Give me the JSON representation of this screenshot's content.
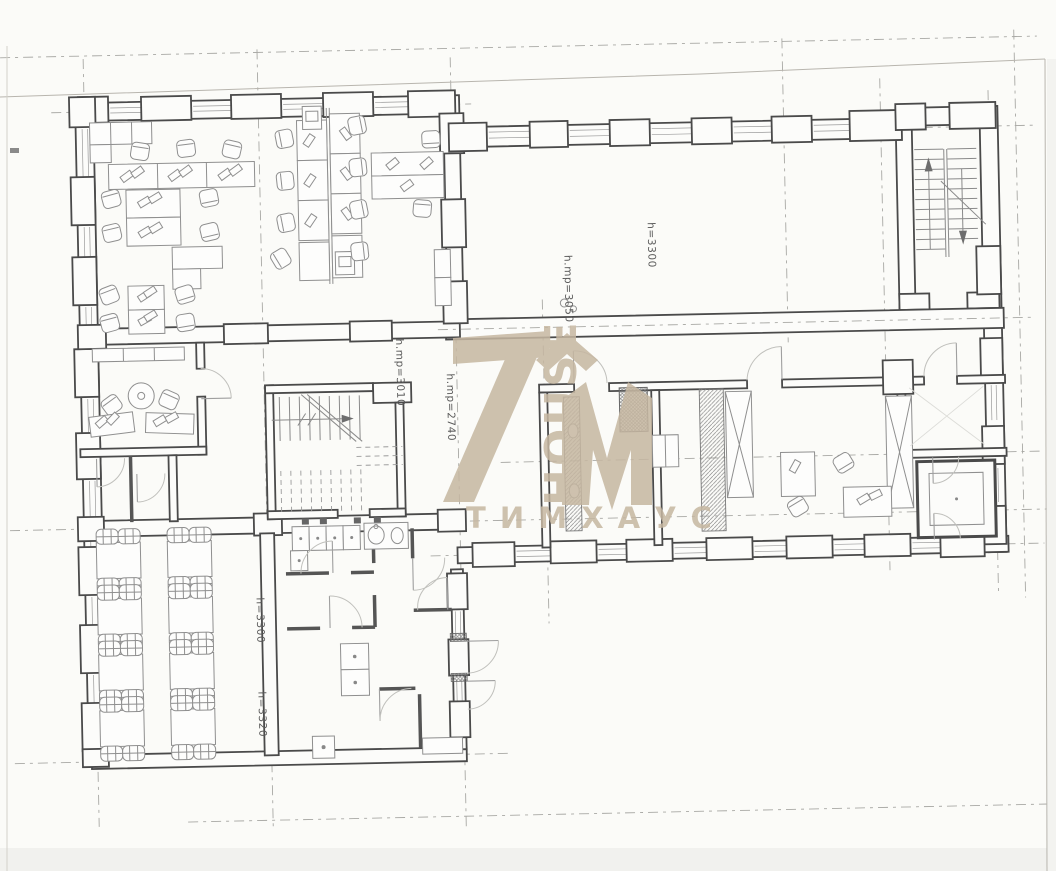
{
  "plan": {
    "height_labels": {
      "hall": "h=3300",
      "hall_clear": "h.mp=3050",
      "stair": "h.mp=3010",
      "landing": "h.mp=2740",
      "cafeteria_1": "h=3300",
      "cafeteria_2": "h=3320"
    }
  },
  "watermark": {
    "logo_text": "TIM",
    "vertical_text": "HOUSE",
    "subtitle": "Т И М Х А У С",
    "color": "#c6b7a1"
  },
  "colors": {
    "paper": "#fbfbf8",
    "wall_line": "#4a4a4a",
    "furniture_line": "#8f8f8f",
    "axis_line": "#a8a8a4"
  }
}
